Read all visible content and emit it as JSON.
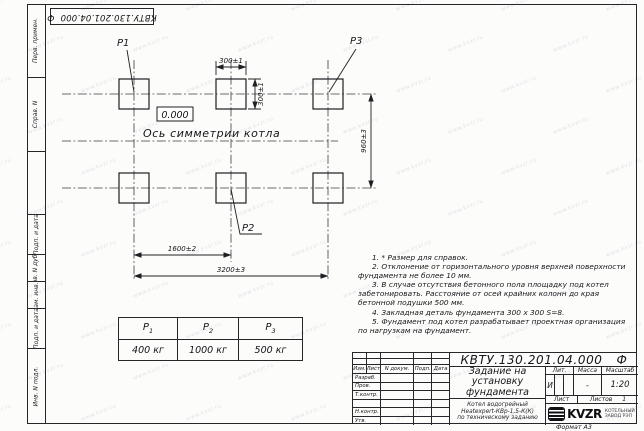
{
  "sheet": {
    "doc_number": "КВТУ.130.201.04.000",
    "doc_suffix": "Ф",
    "format_label": "Формат А3"
  },
  "side_stamps": {
    "perv_primen": "Перв. примен.",
    "sprav_n": "Справ. N",
    "podp_data_1": "Подп. и дата",
    "inv_dubl": "Инв. N дубл.",
    "vzam_inv": "Взам. инв. N",
    "podp_data_2": "Подп. и дата",
    "inv_podl": "Инв. N подл."
  },
  "drawing": {
    "labels": {
      "p1": "P1",
      "p2": "P2",
      "p3": "P3",
      "elevation": "0.000",
      "axis": "Ось симметрии котла"
    },
    "dimensions": {
      "pad_width": "300±1",
      "pad_height": "300±1",
      "row_spacing": "960±3",
      "col_spacing": "1600±2",
      "total_width": "3200±3"
    }
  },
  "notes": [
    "1. * Размер для справок.",
    "2. Отклонение от горизонтального уровня верхней поверхности фундамента не более 10 мм.",
    "3. В случае отсутствия бетонного пола площадку под котел забетонировать. Расстояние от осей крайних колонн до края бетонной подушки 500 мм.",
    "4. Закладная деталь фундамента 300 х 300 S=8.",
    "5. Фундамент под котел разрабатывает проектная организация по нагрузкам на фундамент."
  ],
  "load_table": {
    "headers": [
      {
        "base": "P",
        "sub": "1"
      },
      {
        "base": "P",
        "sub": "2"
      },
      {
        "base": "P",
        "sub": "3"
      }
    ],
    "values": [
      "400 кг",
      "1000 кг",
      "500 кг"
    ]
  },
  "title_block": {
    "title": "Задание на установку фундамента",
    "subtitle_lines": [
      "Котел водогрейный",
      "Heatexpert-КВр-1,5-К(К)",
      "по техническому заданию"
    ],
    "revision_header": [
      "Изм.",
      "Лист",
      "N докум.",
      "Подп.",
      "Дата"
    ],
    "signature_rows": [
      "Разраб.",
      "Пров.",
      "Т.контр.",
      "",
      "Н.контр.",
      "Утв."
    ],
    "lit_label": "Лит.",
    "lit_value": "И",
    "mass_label": "Масса",
    "mass_value": "-",
    "scale_label": "Масштаб",
    "scale_value": "1:20",
    "sheet_label": "Лист",
    "sheets_label": "Листов",
    "sheets_value": "1",
    "logo_text": "KVZR",
    "logo_caption": [
      "КОТЕЛЬНЫЙ",
      "ЗАВОД РЭП"
    ]
  },
  "watermark": {
    "text": "www.kvzr.ru"
  }
}
